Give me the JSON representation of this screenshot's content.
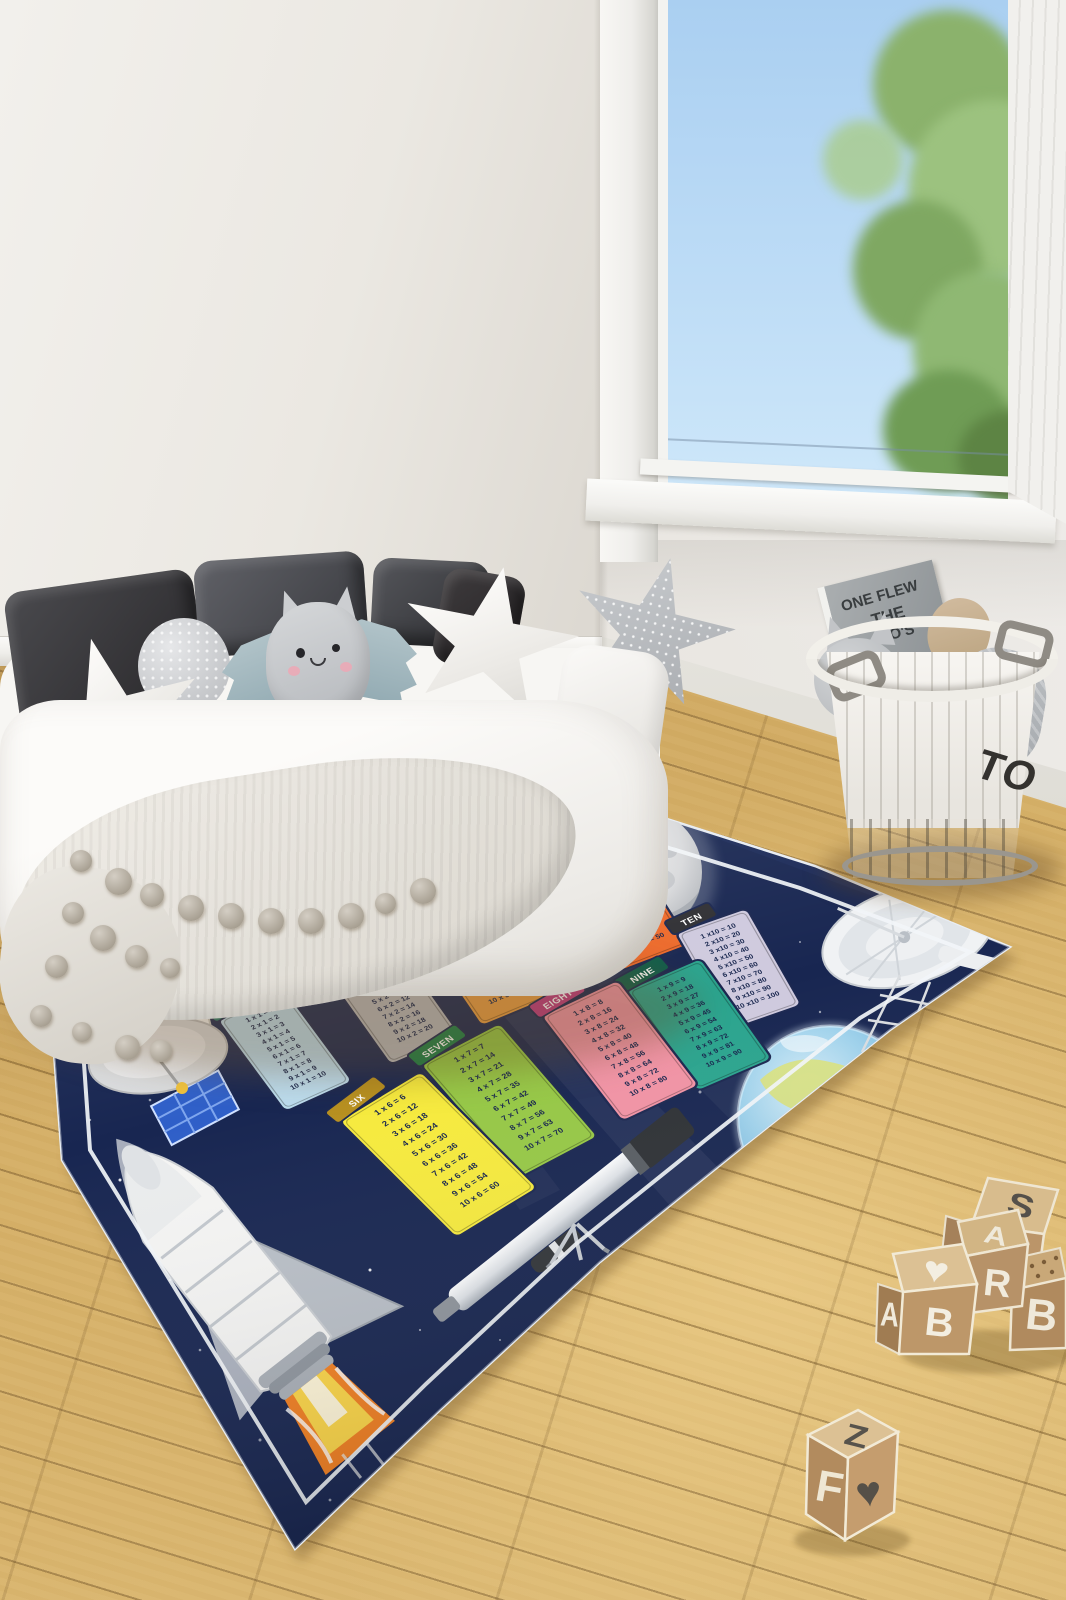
{
  "rug": {
    "title": "SPACE RACE TABLES",
    "background_color": "#1b2a58",
    "border_color": "#ffffff",
    "tables": [
      {
        "id": "one",
        "label": "ONE",
        "header_color": "#2a7a6c",
        "body_color": "#bcdcee",
        "rows": [
          "1 x 1 = 1",
          "2 x 1 = 2",
          "3 x 1 = 3",
          "4 x 1 = 4",
          "5 x 1 = 5",
          "6 x 1 = 6",
          "7 x 1 = 7",
          "8 x 1 = 8",
          "9 x 1 = 9",
          "10 x 1 = 10"
        ]
      },
      {
        "id": "two",
        "label": "TWO",
        "header_color": "#63646a",
        "body_color": "#b7b8bb",
        "rows": [
          "1 x 2 = 2",
          "2 x 2 = 4",
          "3 x 2 = 6",
          "4 x 2 = 8",
          "5 x 2 = 10",
          "6 x 2 = 12",
          "7 x 2 = 14",
          "8 x 2 = 16",
          "9 x 2 = 18",
          "10 x 2 = 20"
        ]
      },
      {
        "id": "three",
        "label": "THREE",
        "header_color": "#c38f45",
        "body_color": "#ea9d42",
        "rows": [
          "1 x 3 = 3",
          "2 x 3 = 6",
          "3 x 3 = 9",
          "4 x 3 = 12",
          "5 x 3 = 15",
          "6 x 3 = 18",
          "7 x 3 = 21",
          "8 x 3 = 24",
          "9 x 3 = 27",
          "10 x 3 = 30"
        ]
      },
      {
        "id": "four",
        "label": "FOUR",
        "header_color": "#b5322b",
        "body_color": "#df5a44",
        "rows": [
          "1 x 4 = 4",
          "2 x 4 = 8",
          "3 x 4 = 12",
          "4 x 4 = 16",
          "5 x 4 = 20",
          "6 x 4 = 24",
          "7 x 4 = 28",
          "8 x 4 = 32",
          "9 x 4 = 36",
          "10 x 4 = 40"
        ]
      },
      {
        "id": "five",
        "label": "FIVE",
        "header_color": "#c64a22",
        "body_color": "#ed6a2b",
        "rows": [
          "1 x 5 = 5",
          "2 x 5 = 10",
          "3 x 5 = 15",
          "4 x 5 = 20",
          "5 x 5 = 25",
          "6 x 5 = 30",
          "7 x 5 = 35",
          "8 x 5 = 40",
          "9 x 5 = 45",
          "10 x 5 = 50"
        ]
      },
      {
        "id": "six",
        "label": "SIX",
        "header_color": "#b78f1f",
        "body_color": "#f6ea3d",
        "rows": [
          "1 x 6 = 6",
          "2 x 6 = 12",
          "3 x 6 = 18",
          "4 x 6 = 24",
          "5 x 6 = 30",
          "6 x 6 = 36",
          "7 x 6 = 42",
          "8 x 6 = 48",
          "9 x 6 = 54",
          "10 x 6 = 60"
        ]
      },
      {
        "id": "seven",
        "label": "SEVEN",
        "header_color": "#1b7f47",
        "body_color": "#96c846",
        "rows": [
          "1 x 7 = 7",
          "2 x 7 = 14",
          "3 x 7 = 21",
          "4 x 7 = 28",
          "5 x 7 = 35",
          "6 x 7 = 42",
          "7 x 7 = 49",
          "8 x 7 = 56",
          "9 x 7 = 63",
          "10 x 7 = 70"
        ]
      },
      {
        "id": "eight",
        "label": "EIGHT",
        "header_color": "#bf3a80",
        "body_color": "#f193a5",
        "rows": [
          "1 x 8 = 8",
          "2 x 8 = 16",
          "3 x 8 = 24",
          "4 x 8 = 32",
          "5 x 8 = 40",
          "6 x 8 = 48",
          "7 x 8 = 56",
          "8 x 8 = 64",
          "9 x 8 = 72",
          "10 x 8 = 80"
        ]
      },
      {
        "id": "nine",
        "label": "NINE",
        "header_color": "#0e5c49",
        "body_color": "#2ba48e",
        "rows": [
          "1 x 9 = 9",
          "2 x 9 = 18",
          "3 x 9 = 27",
          "4 x 9 = 36",
          "5 x 9 = 45",
          "6 x 9 = 54",
          "7 x 9 = 63",
          "8 x 9 = 72",
          "9 x 9 = 81",
          "10 x 9 = 90"
        ]
      },
      {
        "id": "ten",
        "label": "TEN",
        "header_color": "#2f2f33",
        "body_color": "#cfcade",
        "rows": [
          "1 x10 = 10",
          "2 x10 = 20",
          "3 x10 = 30",
          "4 x10 = 40",
          "5 x10 = 50",
          "6 x10 = 60",
          "7 x10 = 70",
          "8 x10 = 80",
          "9 x10 = 90",
          "10 x10 = 100"
        ]
      }
    ],
    "illustrations": [
      "moon",
      "earth",
      "space-shuttle",
      "telescope",
      "satellite",
      "radio-dish",
      "stars"
    ]
  },
  "basket": {
    "label": "TO",
    "book_lines": [
      "ONE FLEW",
      "THE",
      "O'S"
    ]
  },
  "blocks": {
    "cluster": [
      {
        "top": "S",
        "front": "C"
      },
      {
        "top": "A",
        "front": "R"
      },
      {
        "top": "♥",
        "left": "A",
        "front": "B"
      },
      {
        "front": "B"
      }
    ],
    "single": {
      "top": "Z",
      "left": "F",
      "right": "♥"
    }
  },
  "palette": {
    "floor_wood": "#d0a95f",
    "wall": "#ece9e3",
    "sky": "#b8d8f4",
    "tree_green": "#84ad66",
    "rug_navy": "#1b2a58",
    "flame_orange": "#f28022",
    "flame_yellow": "#fcd648"
  }
}
